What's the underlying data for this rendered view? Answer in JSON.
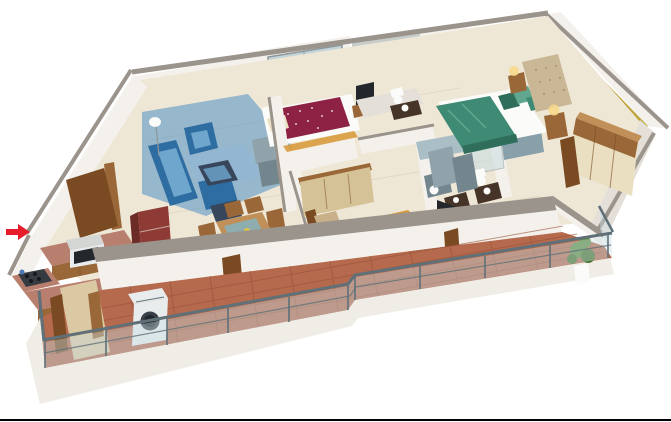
{
  "meta": {
    "description": "3D isometric cutaway render of an apartment floor plan on white background",
    "canvas": {
      "width": 671,
      "height": 422
    }
  },
  "palette": {
    "canvas-bg": "#ffffff",
    "wall": "#f4f1ec",
    "wall-shade": "#e4e0d9",
    "cap": "#9b948c",
    "floor": "#efe7d6",
    "terra": "#b5694d",
    "terra-line": "#98523a",
    "slab": "#f0ede7",
    "glass": "#c7dde2",
    "window-glass": "#c2d4d8",
    "frame": "#8d979c",
    "rail": "#5f7078",
    "living-highlight": "#3f87c2",
    "sofa": "#2e6da1",
    "sofa-light": "#6ea6cd",
    "navy": "#37465a",
    "rug-blue": "#8fb8d8",
    "maroon": "#8e2244",
    "green": "#3f8a74",
    "green-dark": "#2e6e5b",
    "green-light": "#61a78f",
    "gold": "#d99b3e",
    "gold-light": "#eab869",
    "yellow-wall": "#bda43c",
    "tan": "#d5c297",
    "cream-door": "#eadfc1",
    "wood": "#9a6838",
    "wood-dark": "#7a4a22",
    "wood-light": "#c09058",
    "granite": "#b97f6e",
    "fridge": "#8e3a35",
    "fridge-dark": "#6d2b27",
    "tile-bath": "#a9bec5",
    "tile-bath-dark": "#87a0a9",
    "tv": "#23272c",
    "vanity": "#463428",
    "white-fixture": "#fbfbf9",
    "washer": "#e9eced",
    "washer-dark": "#394047",
    "stove": "#363b41",
    "steel": "#d4d6d4",
    "kettle": "#4a7ab8",
    "sink": "#7fb4c4",
    "gray-unit": "#90a3ab",
    "gray-unit-dark": "#73868e",
    "rug-dark": "#2d4335",
    "rug-dark2": "#3e5a4a",
    "plant": "#5d8c3e",
    "plant-dark": "#46702c",
    "arrow": "#e81b2b",
    "lamp-glow": "#f7d98c",
    "pillow-tan": "#c9b089",
    "headboard-tan": "#c9b795",
    "foyer-beige": "#dbc9a3",
    "mirror": "#323c42",
    "stripe-wall": "#c7cdcb",
    "stripe-line": "#9aa6a4",
    "grout": "#e0d5bf",
    "border": "#000000"
  },
  "scene": {
    "view": "3d-isometric-cutaway-floor-plan",
    "rooms": [
      {
        "id": "living-room",
        "highlight": "#3f87c2"
      },
      {
        "id": "dining-area"
      },
      {
        "id": "kitchen"
      },
      {
        "id": "entrance-foyer"
      },
      {
        "id": "bedroom-2",
        "bed_color": "#8e2244"
      },
      {
        "id": "bedroom-3",
        "bed_color": "#d99b3e"
      },
      {
        "id": "master-bedroom",
        "bed_color": "#3f8a74",
        "accent_wall": "#bda43c"
      },
      {
        "id": "bathroom-1"
      },
      {
        "id": "bathroom-2"
      },
      {
        "id": "master-bathroom"
      },
      {
        "id": "back-balcony-left"
      },
      {
        "id": "back-balcony-right"
      },
      {
        "id": "front-terrace",
        "floor": "#b5694d"
      }
    ],
    "markers": [
      {
        "id": "entrance-arrow",
        "color": "#e81b2b",
        "direction": "right"
      }
    ]
  }
}
